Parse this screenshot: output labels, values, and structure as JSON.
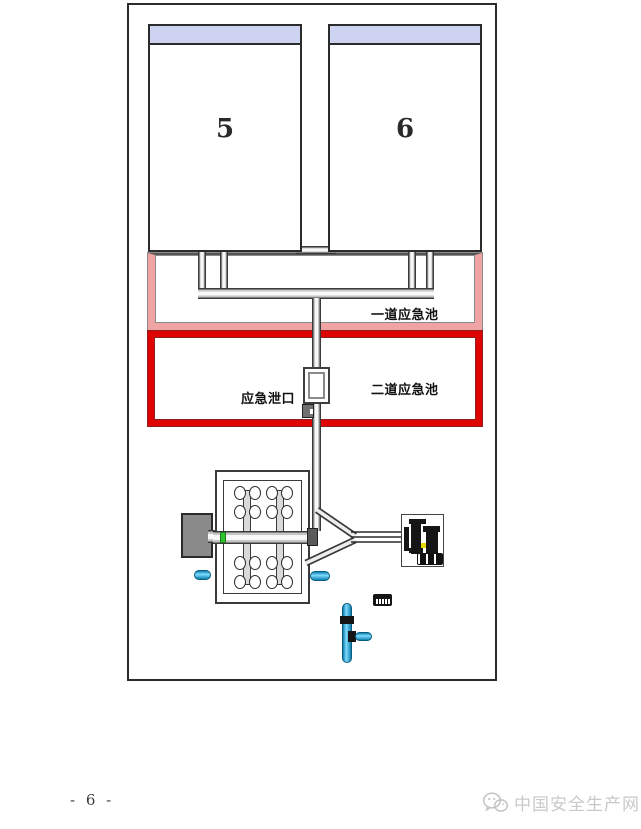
{
  "document": {
    "page_number": "- 6 -",
    "watermark": {
      "text": "中国安全生产网",
      "icon": "wechat-bubbles-icon",
      "color": "#c9c9c9"
    }
  },
  "diagram": {
    "tanks": [
      {
        "label": "5",
        "band_color": "#cdd3f0"
      },
      {
        "label": "6",
        "band_color": "#cdd3f0"
      }
    ],
    "pools": [
      {
        "label": "一道应急池",
        "border_color": "#f0a3a3"
      },
      {
        "label": "二道应急池",
        "border_color": "#de0404"
      }
    ],
    "outlet_label": "应急泄口",
    "colors": {
      "valve_green": "#2ec52e",
      "equipment_blue": "#2fb3e6",
      "gray_equipment_box": "#8a8a8a",
      "pipe_outline": "#3a3a3a"
    }
  }
}
